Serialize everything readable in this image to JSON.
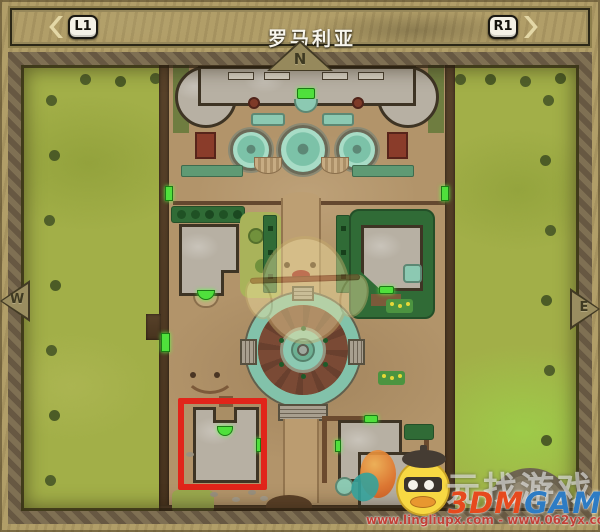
{
  "header": {
    "prev_arrow_icon": "chevron-left",
    "next_arrow_icon": "chevron-right",
    "left_bumper": "L1",
    "right_bumper": "R1",
    "title": "罗马利亚"
  },
  "compass": {
    "north": "N",
    "west": "W",
    "east": "E"
  },
  "map": {
    "marker_green": "#4fe03c",
    "highlight_red": "#e1251a",
    "water_teal": "#84c2aa",
    "grass_green": "#a2af48"
  },
  "watermarks": {
    "site_slogan": "元找游戏",
    "brand_left": "3DM",
    "brand_right": "GAME",
    "url_line": "www.lingliupx.com - www.062yx.com"
  }
}
